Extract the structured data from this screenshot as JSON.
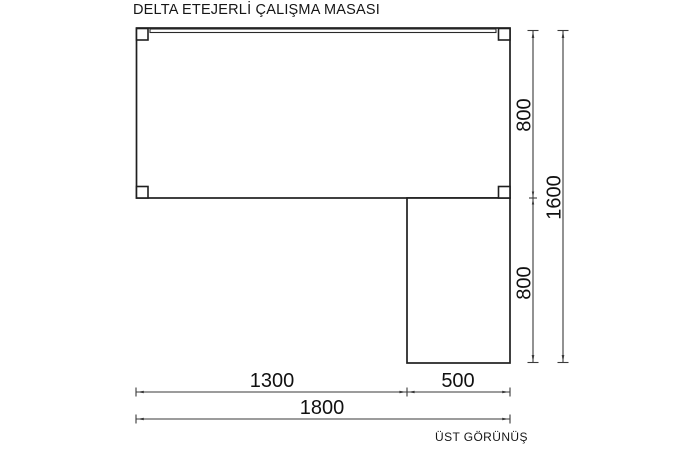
{
  "title": "DELTA ETEJERLİ ÇALIŞMA MASASI",
  "view_label": "ÜST GÖRÜNÜŞ",
  "colors": {
    "background": "#ffffff",
    "outline": "#1f1f1f",
    "dimension_lines": "#3a3a3a",
    "text": "#111111"
  },
  "dimensions": {
    "depth_top": "800",
    "depth_bottom": "800",
    "depth_total": "1600",
    "width_main": "1300",
    "width_return": "500",
    "width_total": "1800"
  }
}
